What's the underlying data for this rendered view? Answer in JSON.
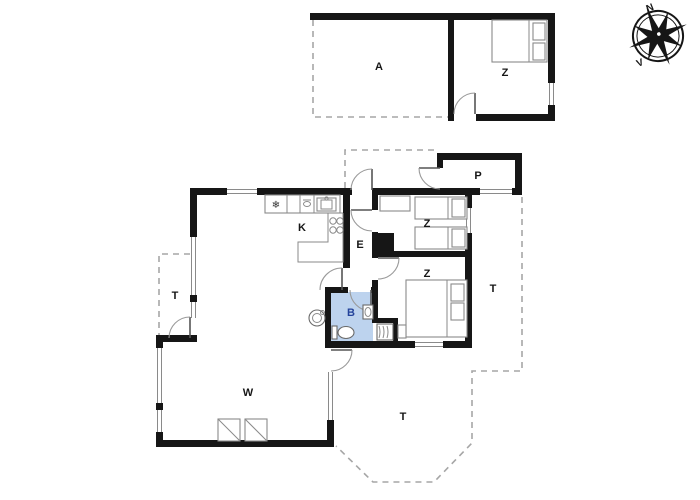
{
  "compass": {
    "north_label": "N",
    "west_label": "V"
  },
  "rooms": {
    "annex_room": {
      "label": "A"
    },
    "annex_bedroom": {
      "label": "Z"
    },
    "utility": {
      "label": "P"
    },
    "kitchen": {
      "label": "K"
    },
    "entry": {
      "label": "E"
    },
    "bedroom_1": {
      "label": "Z"
    },
    "bedroom_2": {
      "label": "Z"
    },
    "bathroom": {
      "label": "B"
    },
    "living_room": {
      "label": "W"
    },
    "terrace_left": {
      "label": "T"
    },
    "terrace_right": {
      "label": "T"
    },
    "terrace_bottom": {
      "label": "T"
    }
  },
  "icons": {
    "freezer_glyph": "❄"
  },
  "colors": {
    "wall": "#161616",
    "bathroom_fill": "#bdd3ee",
    "bathroom_label": "#24439b",
    "dash_line": "#a6a6a6",
    "furniture_line": "#8a8a8a",
    "background": "#ffffff"
  }
}
